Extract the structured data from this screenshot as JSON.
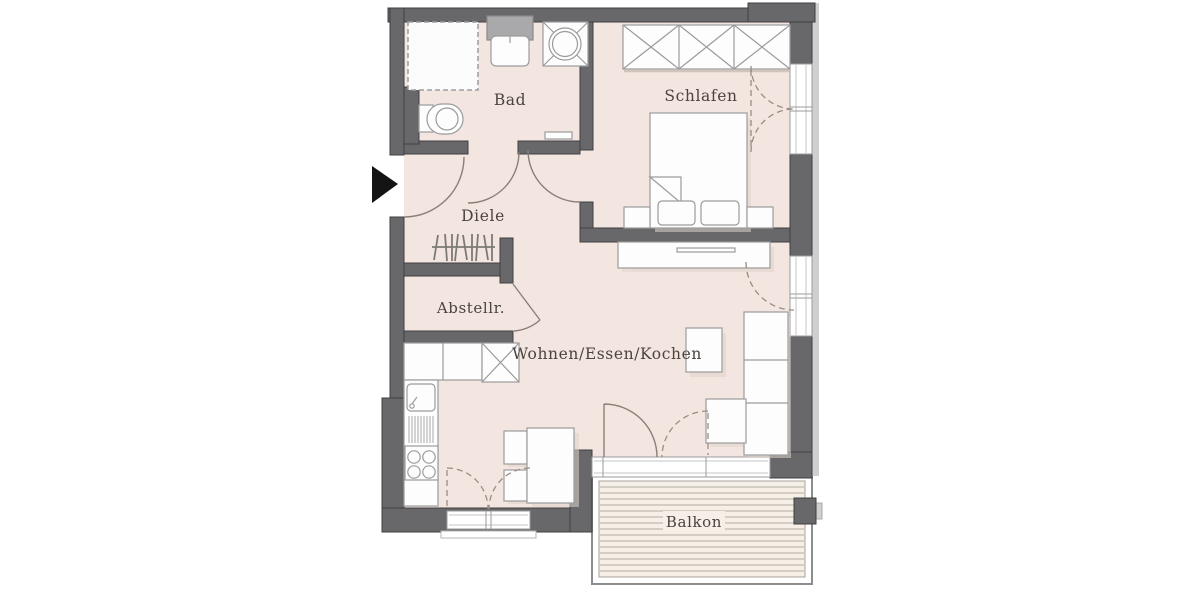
{
  "plan_title": "Apartment floor plan",
  "rooms": {
    "bad": {
      "label": "Bad"
    },
    "schlafen": {
      "label": "Schlafen"
    },
    "diele": {
      "label": "Diele"
    },
    "abstellraum": {
      "label": "Abstellr."
    },
    "wohnen_essen_kochen": {
      "label": "Wohnen/Essen/Kochen"
    },
    "balkon": {
      "label": "Balkon"
    }
  },
  "icons": {
    "entrance-arrow-icon": "black right-pointing triangle at entry door",
    "shower-icon": "dashed square",
    "toilet-icon": "rounded rect with bowl circle",
    "bath-sink-icon": "basin with backsplash counter",
    "washing-machine-icon": "square with circle and corner diagonals",
    "wardrobe-icon": "three crossed boxes",
    "bed-icon": "bed with folded corner, two pillows, nightstands",
    "sideboard-icon": "low board with handle slot",
    "sofa-icon": "L-shaped sofa with chaise",
    "side-table-icon": "small square table",
    "dining-table-icon": "table with two chairs",
    "kitchen-icon": "counter with sink, drainer, 4-burner stove, tall crossed unit",
    "coat-rack-icon": "hatched stroke symbol in hallway",
    "balcony-decking-icon": "horizontal plank lines"
  },
  "colors": {
    "wall": "#68686a",
    "wall_outline": "#3f3f41",
    "floor": "#f3e6e0",
    "balcony_floor": "#f5efe7",
    "deck_line": "#b3aba0",
    "furniture_fill": "#fdfdfd",
    "furniture_stroke": "#9b9b9d",
    "shadow": "#ded3cc",
    "door_arc": "#8a7f78",
    "dashed_arc": "#9a8d84",
    "label_text": "#4a433e",
    "entrance_arrow": "#141414",
    "exterior_trim": "#cfcfd1"
  }
}
